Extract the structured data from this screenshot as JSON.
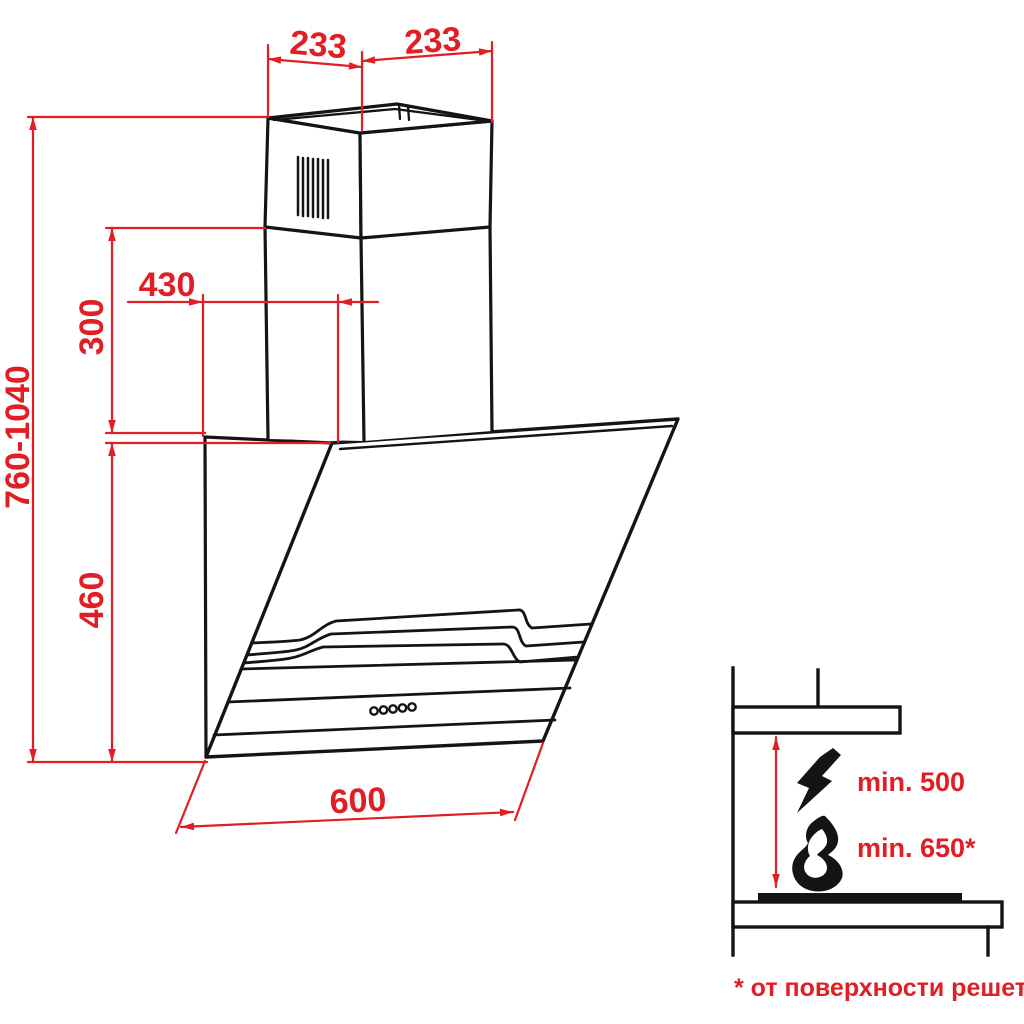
{
  "title": "cooker hood installation dimensions drawing",
  "dimensions": {
    "duct_top_left": "233",
    "duct_top_right": "233",
    "height_total": "760-1040",
    "chimney_section": "300",
    "depth_top": "430",
    "body_height": "460",
    "body_width": "600"
  },
  "clearances": {
    "electric_hob": "min. 500",
    "gas_hob": "min. 650*"
  },
  "footnote": "* от поверхности решеток",
  "icons": [
    "lightning-icon",
    "flame-icon"
  ],
  "colors": {
    "dimension_red": "#e01e23",
    "drawing_black": "#141414",
    "background": "#ffffff"
  }
}
